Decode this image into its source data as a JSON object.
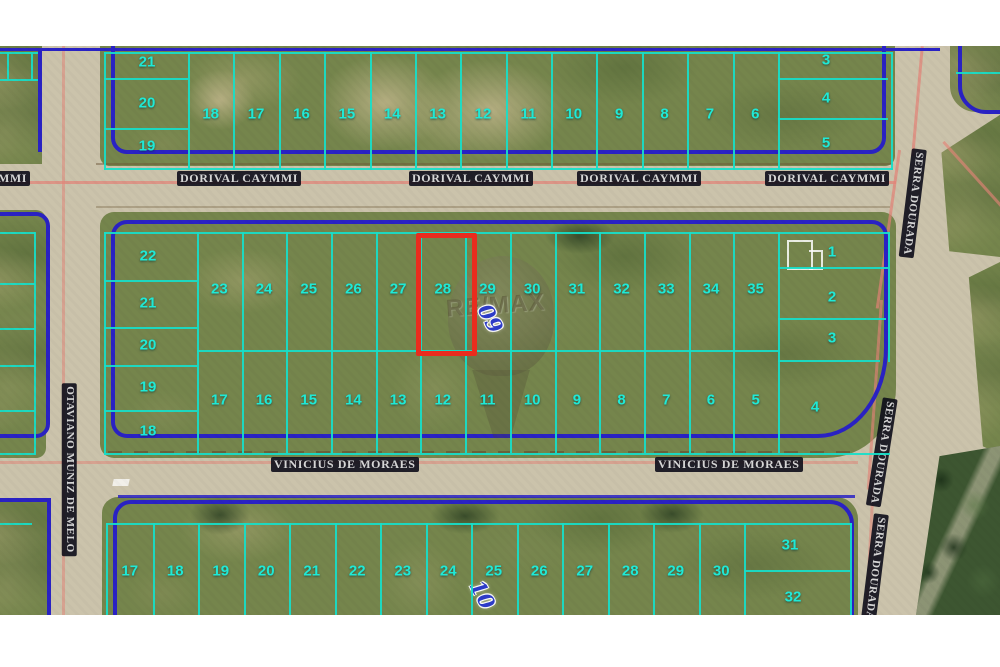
{
  "watermark": {
    "brand": "RE/MAX"
  },
  "quadra_labels": {
    "middle_block": "09",
    "bottom_block": "10"
  },
  "streets": {
    "dorival_caymmi": "DORIVAL CAYMMI",
    "vinicius_de_moraes": "VINICIUS DE MORAES",
    "serra_dourada": "SERRA DOURADA",
    "otaviano_muniz_de_melo": "OTAVIANO MUNIZ DE MELO"
  },
  "highlight": {
    "lot_number": "28"
  },
  "blocks": {
    "top": {
      "left_column": [
        "21",
        "20",
        "19"
      ],
      "main_row": [
        "18",
        "17",
        "16",
        "15",
        "14",
        "13",
        "12",
        "11",
        "10",
        "9",
        "8",
        "7",
        "6"
      ],
      "right_column": [
        "3",
        "4",
        "5"
      ]
    },
    "middle": {
      "left_column": [
        "22",
        "21",
        "20",
        "19",
        "18"
      ],
      "top_row": [
        "23",
        "24",
        "25",
        "26",
        "27",
        "28",
        "29",
        "30",
        "31",
        "32",
        "33",
        "34",
        "35"
      ],
      "bottom_row": [
        "17",
        "16",
        "15",
        "14",
        "13",
        "12",
        "11",
        "10",
        "9",
        "8",
        "7",
        "6",
        "5"
      ],
      "right_column": [
        "1",
        "2",
        "3"
      ],
      "corner_lot": "4"
    },
    "bottom": {
      "main_row": [
        "17",
        "18",
        "19",
        "20",
        "21",
        "22",
        "23",
        "24",
        "25",
        "26",
        "27",
        "28",
        "29",
        "30"
      ],
      "right_column": [
        "31",
        "32"
      ]
    }
  },
  "colors": {
    "lot_line": "#17dfc9",
    "lot_number": "#1fe9d6",
    "block_border": "#2a22c4",
    "highlight_box": "#e92c1e",
    "road_centerline": "#e28276",
    "quadra_number": "#2d3cc8",
    "road": "#cbc3ab",
    "grass": "#75854c"
  }
}
